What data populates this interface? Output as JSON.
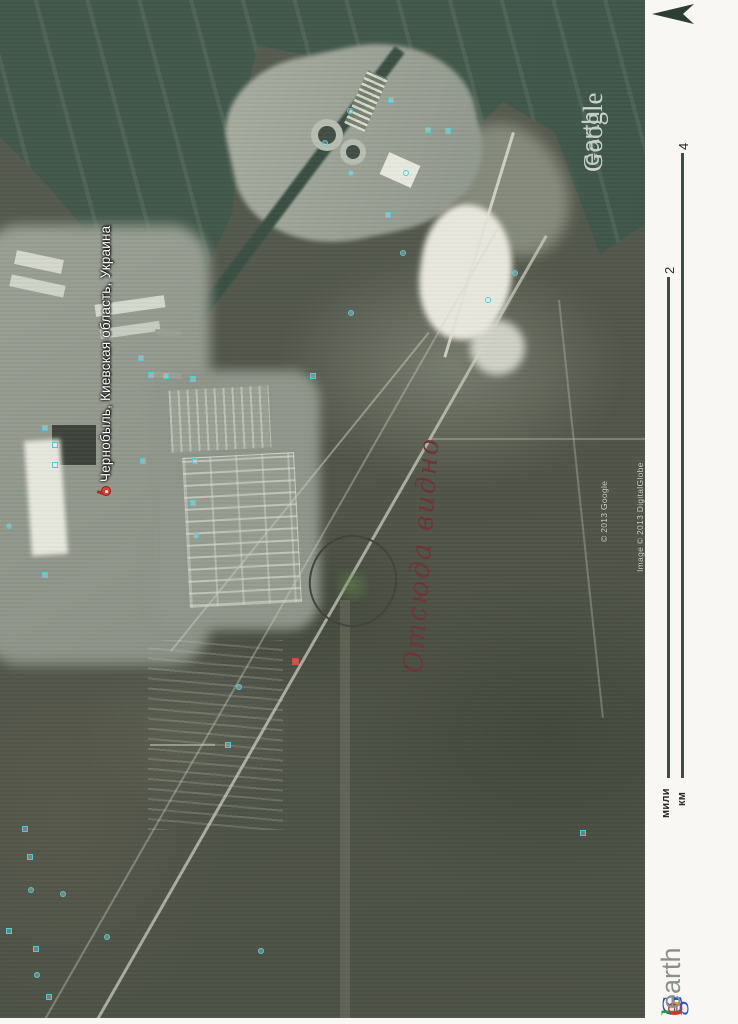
{
  "map": {
    "placemark": {
      "label": "Чернобыль, Киевская область, Украина"
    },
    "annotation": {
      "text": "Отсюда видно"
    },
    "watermark": {
      "google": "Google",
      "earth": "earth"
    },
    "credits": {
      "google": "© 2013 Google",
      "digitalglobe": "Image © 2013 DigitalGlobe"
    },
    "photo_icons": [
      {
        "x": 22,
        "y": 826,
        "s": "sq"
      },
      {
        "x": 27,
        "y": 854,
        "s": "sq"
      },
      {
        "x": 28,
        "y": 887,
        "s": "ci"
      },
      {
        "x": 6,
        "y": 928,
        "s": "sq"
      },
      {
        "x": 33,
        "y": 946,
        "s": "sq"
      },
      {
        "x": 34,
        "y": 972,
        "s": "ci"
      },
      {
        "x": 46,
        "y": 994,
        "s": "sq"
      },
      {
        "x": 104,
        "y": 934,
        "s": "ci"
      },
      {
        "x": 60,
        "y": 891,
        "s": "ci"
      },
      {
        "x": 148,
        "y": 372,
        "s": "sq"
      },
      {
        "x": 190,
        "y": 376,
        "s": "sq"
      },
      {
        "x": 192,
        "y": 458,
        "s": "sq"
      },
      {
        "x": 190,
        "y": 500,
        "s": "sq"
      },
      {
        "x": 193,
        "y": 533,
        "s": "ci"
      },
      {
        "x": 310,
        "y": 373,
        "s": "sq"
      },
      {
        "x": 140,
        "y": 458,
        "s": "sq"
      },
      {
        "x": 347,
        "y": 108,
        "s": "ci"
      },
      {
        "x": 388,
        "y": 97,
        "s": "sq"
      },
      {
        "x": 322,
        "y": 140,
        "s": "ci"
      },
      {
        "x": 348,
        "y": 170,
        "s": "ci"
      },
      {
        "x": 425,
        "y": 127,
        "s": "sq"
      },
      {
        "x": 445,
        "y": 128,
        "s": "sq"
      },
      {
        "x": 403,
        "y": 170,
        "s": "ci"
      },
      {
        "x": 385,
        "y": 212,
        "s": "sq"
      },
      {
        "x": 400,
        "y": 250,
        "s": "ci"
      },
      {
        "x": 512,
        "y": 270,
        "s": "ci"
      },
      {
        "x": 485,
        "y": 297,
        "s": "ci"
      },
      {
        "x": 348,
        "y": 310,
        "s": "ci"
      },
      {
        "x": 138,
        "y": 355,
        "s": "sq"
      },
      {
        "x": 163,
        "y": 373,
        "s": "sq"
      },
      {
        "x": 42,
        "y": 425,
        "s": "sq"
      },
      {
        "x": 52,
        "y": 442,
        "s": "sq"
      },
      {
        "x": 52,
        "y": 462,
        "s": "sq"
      },
      {
        "x": 6,
        "y": 523,
        "s": "ci"
      },
      {
        "x": 42,
        "y": 572,
        "s": "sq"
      },
      {
        "x": 258,
        "y": 948,
        "s": "ci"
      },
      {
        "x": 580,
        "y": 830,
        "s": "sq"
      },
      {
        "x": 236,
        "y": 684,
        "s": "ci"
      },
      {
        "x": 225,
        "y": 742,
        "s": "sq"
      },
      {
        "x": 292,
        "y": 658,
        "s": "red"
      }
    ]
  },
  "margin": {
    "scale": {
      "miles_value": "2",
      "km_value": "4",
      "miles_unit": "мили",
      "km_unit": "км"
    },
    "logo": {
      "letters": [
        {
          "ch": "G",
          "color": "#2a56c6"
        },
        {
          "ch": "o",
          "color": "#d93025"
        },
        {
          "ch": "o",
          "color": "#e8a012"
        },
        {
          "ch": "g",
          "color": "#2a56c6"
        },
        {
          "ch": "l",
          "color": "#1e9e3e"
        },
        {
          "ch": "e",
          "color": "#d93025"
        }
      ],
      "earth": "earth"
    }
  },
  "icons": {
    "north_arrow": "north-arrow-icon",
    "photo": "photo-icon",
    "red_placemark": "placemark-icon"
  },
  "colors": {
    "water": "#41574a",
    "forest": "#4e5348",
    "industrial": "#9da294",
    "sand": "#e9e8de",
    "margin_bg": "#f8f7f3",
    "scale_bar": "#3c4f44",
    "annotation_ink": "#6e3339",
    "circle_ink": "#43423c",
    "pin_red": "#e23d30",
    "photo_icon_cyan": "#49cfe0"
  }
}
